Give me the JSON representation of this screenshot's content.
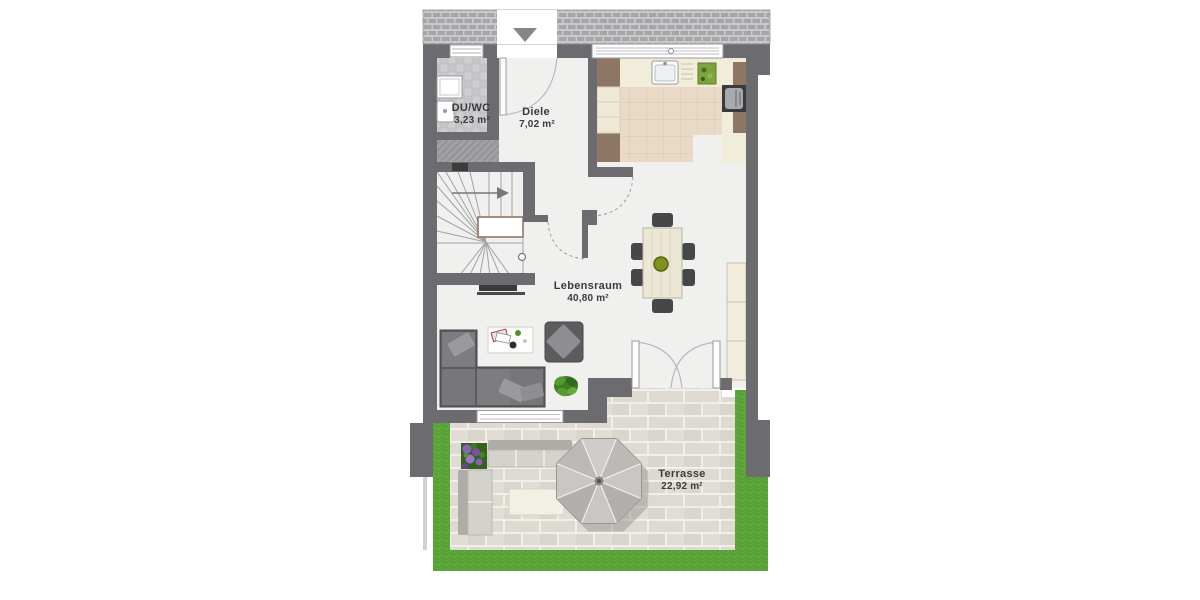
{
  "floorplan": {
    "rooms": [
      {
        "id": "duwc",
        "name": "DU/WC",
        "area": "3,23 m²"
      },
      {
        "id": "diele",
        "name": "Diele",
        "area": "7,02 m²"
      },
      {
        "id": "lebensraum",
        "name": "Lebensraum",
        "area": "40,80 m²"
      },
      {
        "id": "terrasse",
        "name": "Terrasse",
        "area": "22,92 m²"
      }
    ],
    "icons": {
      "entrance_arrow": "triangle-down",
      "stair_direction_arrow": "arrow-right"
    },
    "features": [
      "entrance-door",
      "staircase",
      "shower",
      "washbasin",
      "kitchen-counter",
      "kitchen-sink",
      "stove",
      "cutting-board",
      "dining-table",
      "dining-chairs",
      "tv",
      "corner-sofa",
      "coffee-table",
      "armchair",
      "houseplant",
      "shelf-unit",
      "french-doors",
      "outdoor-lounge",
      "outdoor-table",
      "parasol",
      "flower-planter",
      "lawn",
      "paving"
    ],
    "colors": {
      "wall": "#6b6b70",
      "interior_floor": "#f0f0ee",
      "kitchen_floor": "#ead9c6",
      "bath_tile": "#cfcfd1",
      "grass": "#5ca539",
      "paving": "#dedad2",
      "furniture_dark": "#5c5c5f",
      "wood_cream": "#ece6d4",
      "cabinet_brown": "#8d7663",
      "label_text": "#3b3b3d"
    }
  }
}
